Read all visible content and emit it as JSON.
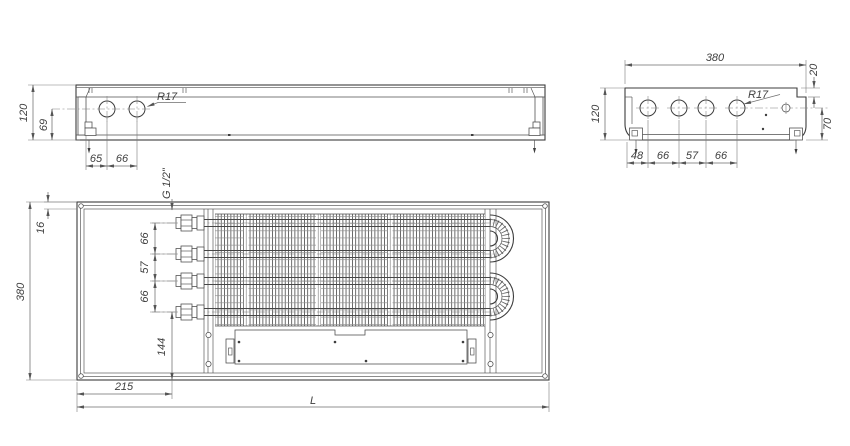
{
  "views": {
    "side": {
      "title": "side-view",
      "dims": {
        "height": "120",
        "hole_center_from_bottom": "69",
        "hole_offset_left": "65",
        "hole_pitch": "66",
        "hole_radius": "R17"
      }
    },
    "end": {
      "title": "end-view",
      "dims": {
        "width": "380",
        "top_step": "20",
        "height": "120",
        "right_height": "70",
        "h1": "48",
        "h2": "66",
        "h3": "57",
        "h4": "66",
        "hole_radius": "R17"
      }
    },
    "plan": {
      "title": "plan-view",
      "dims": {
        "frame_width": "16",
        "depth": "380",
        "pipe_thread": "G 1/2\"",
        "pitch1": "66",
        "pitch2": "57",
        "pitch3": "66",
        "tail": "144",
        "inlet_offset": "215",
        "length": "L"
      }
    }
  }
}
